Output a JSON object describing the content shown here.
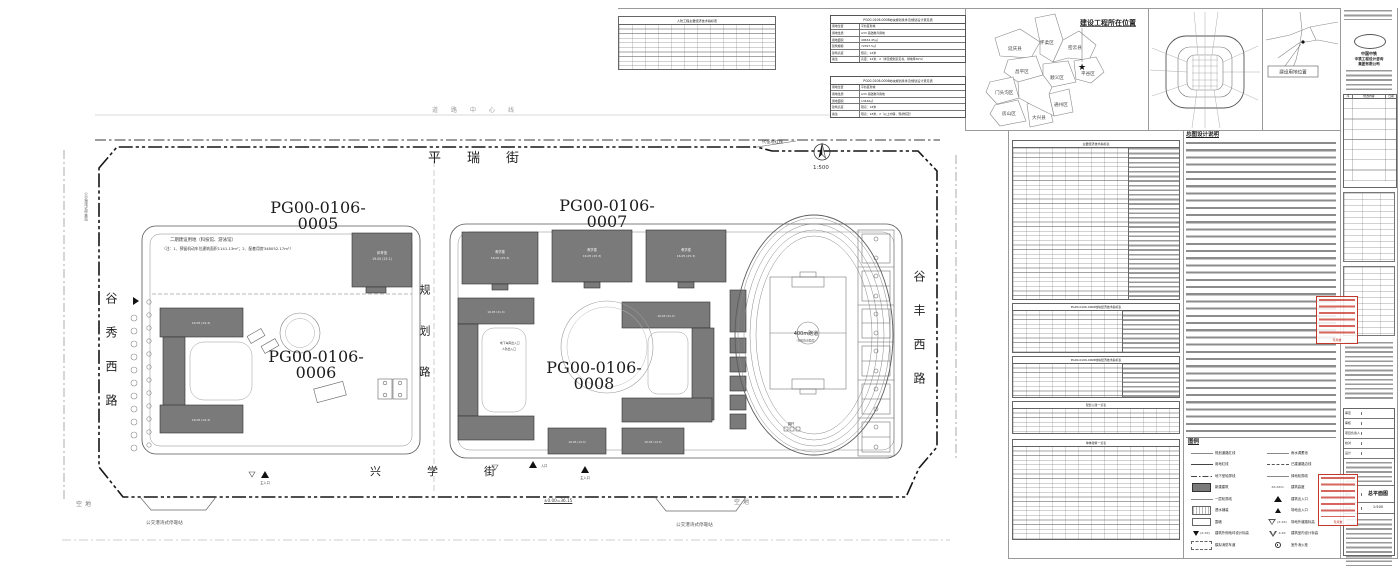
{
  "streets": {
    "north": "平瑞街",
    "south": "兴学街",
    "west": "谷秀西路",
    "east": "谷丰西路",
    "middle": "规划路",
    "centerline_note": "道路中心线",
    "redline_label": "代征地红线"
  },
  "parcels": {
    "p5": "PG00-0106-0005",
    "p6": "PG00-0106-0006",
    "p7": "PG00-0106-0007",
    "p8": "PG00-0106-0008",
    "p5_note1": "二期建设用地（科技馆、游泳馆）",
    "p5_note2": "（注：1、预留机动车位建筑面积1141.13m²；2、配套用房348052.17m²）"
  },
  "plan": {
    "gym_name": "体育馆",
    "gym_elev": "19.00 (25.1)",
    "bld7": [
      {
        "name": "教学楼",
        "elev": "16.05 (25.3)"
      },
      {
        "name": "教学楼",
        "elev": "16.05 (25.3)"
      },
      {
        "name": "教学楼",
        "elev": "16.05 (25.3)"
      }
    ],
    "dorm_elev": "16.05 (19.3)",
    "b8_elev": "16.05 (21.3)",
    "b8b_elev": "10.05 (14.3)",
    "garage_label": "地下车库出入口",
    "civil_label": "人防出入口",
    "track_label": "400m跑道",
    "track_sub": "(塑胶跑道面层)",
    "flag": "旗杆",
    "entrance_main": "主入口",
    "entrance": "入口",
    "datum": "±0.00=36.15",
    "empty": "空地",
    "bus_stop": "公交港湾式停靠站",
    "north_scale": "1:500"
  },
  "top_tables": {
    "t_a_title": "人防工程主要经济技术指标表",
    "t_b1_title": "PG00-0106-0008地块规划条件及规划设计意见表",
    "t_b1_rows": [
      [
        "用地位置",
        "平谷区新城"
      ],
      [
        "用地性质",
        "A33 基础教育用地"
      ],
      [
        "用地面积",
        "49634.45㎡"
      ],
      [
        "建筑规模",
        "72397.5㎡"
      ],
      [
        "建筑高度",
        "限高：24米"
      ],
      [
        "备注",
        "高度：24米，2（详见规划意见书，绿地率30%）"
      ]
    ],
    "t_b2_title": "PG00-0106-0006地块规划条件及规划设计意见表",
    "t_b2_rows": [
      [
        "用地位置",
        "平谷区新城"
      ],
      [
        "用地性质",
        "A33 基础教育用地"
      ],
      [
        "用地面积",
        "13446㎡"
      ],
      [
        "建筑高度",
        "限高：18米"
      ],
      [
        "备注",
        "限高：18米，2（以上内容，现状核定）"
      ]
    ]
  },
  "maps": {
    "beijing_title": "建设工程所在位置",
    "districts": [
      "延庆县",
      "怀柔区",
      "密云县",
      "昌平区",
      "顺义区",
      "平谷区",
      "门头沟区",
      "房山区",
      "大兴县",
      "通州区"
    ],
    "location_label": "建设用地位置"
  },
  "titleblock": {
    "company1": "中国中铁",
    "company2": "中铁工程设计咨询",
    "company3": "集团有限公司",
    "rev_headers": [
      "序",
      "修改内容",
      "日期"
    ],
    "sign_rows": [
      "审定",
      "审核",
      "项目负责人",
      "校对",
      "设计"
    ],
    "drawing_name_label": "图名",
    "drawing_name": "总平面图",
    "scale_label": "比例",
    "scale": "1:500",
    "stamp_text": "专用章"
  },
  "notes": {
    "title": "总图设计说明"
  },
  "tables": {
    "t1": "主要经济技术指标表",
    "t2": "PG00-0106-0006地块经济技术指标表",
    "t3": "PG00-0106-0008地块经济技术指标表",
    "t4": "配套公建一览表",
    "t5": "单体建筑一览表"
  },
  "legend": {
    "title": "图例",
    "left": [
      "规划道路红线",
      "用地红线",
      "地下室轮廓线",
      "新建建筑",
      "一层轮廓线",
      "透水铺装",
      "围墙",
      "建筑外侧地坪设计标高",
      "模拟消防车道"
    ],
    "right": [
      "雨水调蓄池",
      "已建道路边线",
      "绿地轮廓线",
      "建筑高度",
      "建筑出入口",
      "场地出入口",
      "场地外道路标高",
      "建筑室内设计标高",
      "室外消火栓"
    ],
    "height_sym": "XX.XXm",
    "elev_sym": "(X.XX)",
    "elev_sym2": "X.XX"
  }
}
